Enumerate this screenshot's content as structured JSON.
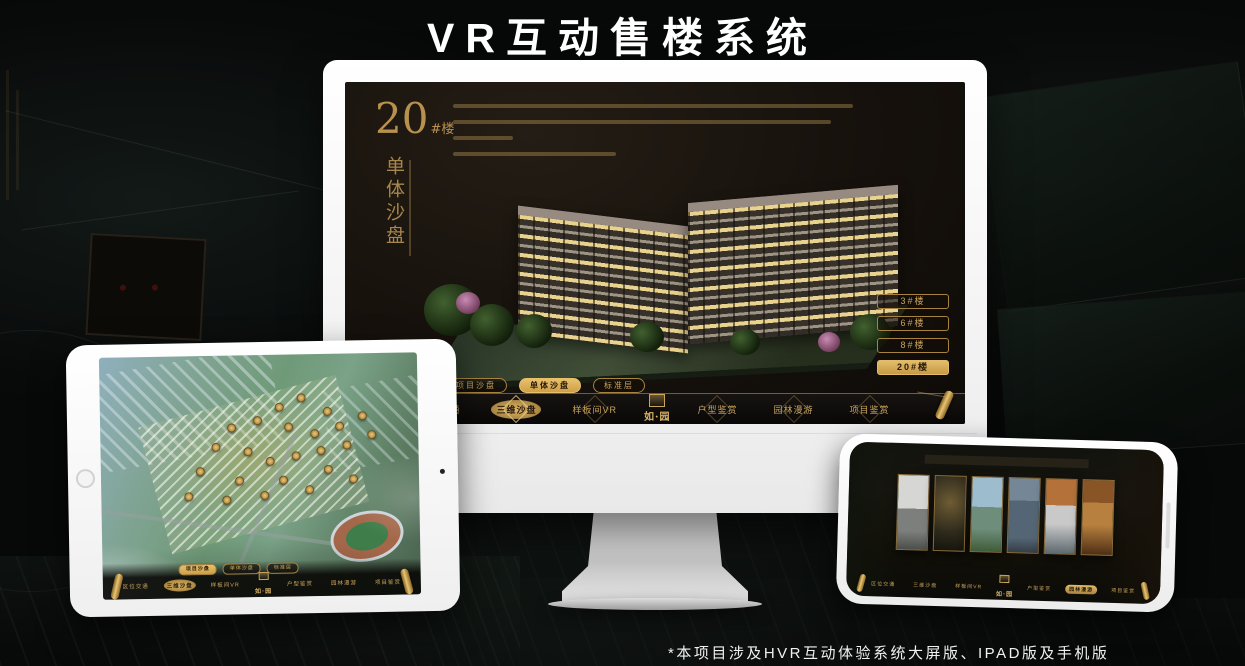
{
  "page": {
    "title": "VR互动售楼系统",
    "footnote": "*本项目涉及HVR互动体验系统大屏版、IPAD版及手机版"
  },
  "colors": {
    "gold": "#c9a45c",
    "gold_bright": "#e3bc6a",
    "screen_bg": "#16110c"
  },
  "monitor": {
    "screen": {
      "block_title_big": "20",
      "block_title_small": "#楼",
      "block_subtitle_vertical": "单体沙盘",
      "description_line_widths": [
        93,
        88,
        14,
        38
      ],
      "building_buttons": [
        {
          "label": "3#楼",
          "active": false
        },
        {
          "label": "6#楼",
          "active": false
        },
        {
          "label": "8#楼",
          "active": false
        },
        {
          "label": "20#楼",
          "active": true
        }
      ],
      "sub_tabs": [
        {
          "label": "项目沙盘",
          "active": false
        },
        {
          "label": "单体沙盘",
          "active": true
        },
        {
          "label": "标准层",
          "active": false
        }
      ],
      "nav_left": [
        {
          "label": "区位交通",
          "active": false
        },
        {
          "label": "三维沙盘",
          "active": true
        },
        {
          "label": "样板间VR",
          "active": false
        }
      ],
      "nav_right": [
        {
          "label": "户型鉴赏",
          "active": false
        },
        {
          "label": "园林漫游",
          "active": false
        },
        {
          "label": "项目鉴赏",
          "active": false
        }
      ],
      "logo_text": "如·园"
    }
  },
  "tablet": {
    "screen": {
      "sub_tabs": [
        {
          "label": "项目沙盘",
          "active": true
        },
        {
          "label": "单体沙盘",
          "active": false
        },
        {
          "label": "标准层",
          "active": false
        }
      ],
      "nav_left": [
        {
          "label": "区位交通",
          "active": false
        },
        {
          "label": "三维沙盘",
          "active": true
        },
        {
          "label": "样板间VR",
          "active": false
        }
      ],
      "nav_right": [
        {
          "label": "户型鉴赏",
          "active": false
        },
        {
          "label": "园林漫游",
          "active": false
        },
        {
          "label": "项目鉴赏",
          "active": false
        }
      ],
      "logo_text": "如·园",
      "markers": [
        [
          62,
          16
        ],
        [
          70,
          22
        ],
        [
          55,
          20
        ],
        [
          48,
          25
        ],
        [
          40,
          28
        ],
        [
          58,
          28
        ],
        [
          66,
          31
        ],
        [
          74,
          28
        ],
        [
          81,
          24
        ],
        [
          35,
          36
        ],
        [
          45,
          38
        ],
        [
          52,
          42
        ],
        [
          60,
          40
        ],
        [
          68,
          38
        ],
        [
          76,
          36
        ],
        [
          84,
          32
        ],
        [
          30,
          46
        ],
        [
          42,
          50
        ],
        [
          56,
          50
        ],
        [
          70,
          46
        ],
        [
          26,
          56
        ],
        [
          38,
          58
        ],
        [
          50,
          56
        ],
        [
          64,
          54
        ],
        [
          78,
          50
        ]
      ]
    }
  },
  "phone": {
    "screen": {
      "nav_left": [
        {
          "label": "区位交通",
          "active": false
        },
        {
          "label": "三维沙盘",
          "active": false
        },
        {
          "label": "样板间VR",
          "active": false
        }
      ],
      "nav_right": [
        {
          "label": "户型鉴赏",
          "active": false
        },
        {
          "label": "园林漫游",
          "active": true
        },
        {
          "label": "项目鉴赏",
          "active": false
        }
      ],
      "logo_text": "如·园",
      "gallery_panels": [
        "panel-grey",
        "panel-interior-dark",
        "panel-sky",
        "panel-facade",
        "panel-autumn",
        "panel-warm"
      ]
    }
  }
}
